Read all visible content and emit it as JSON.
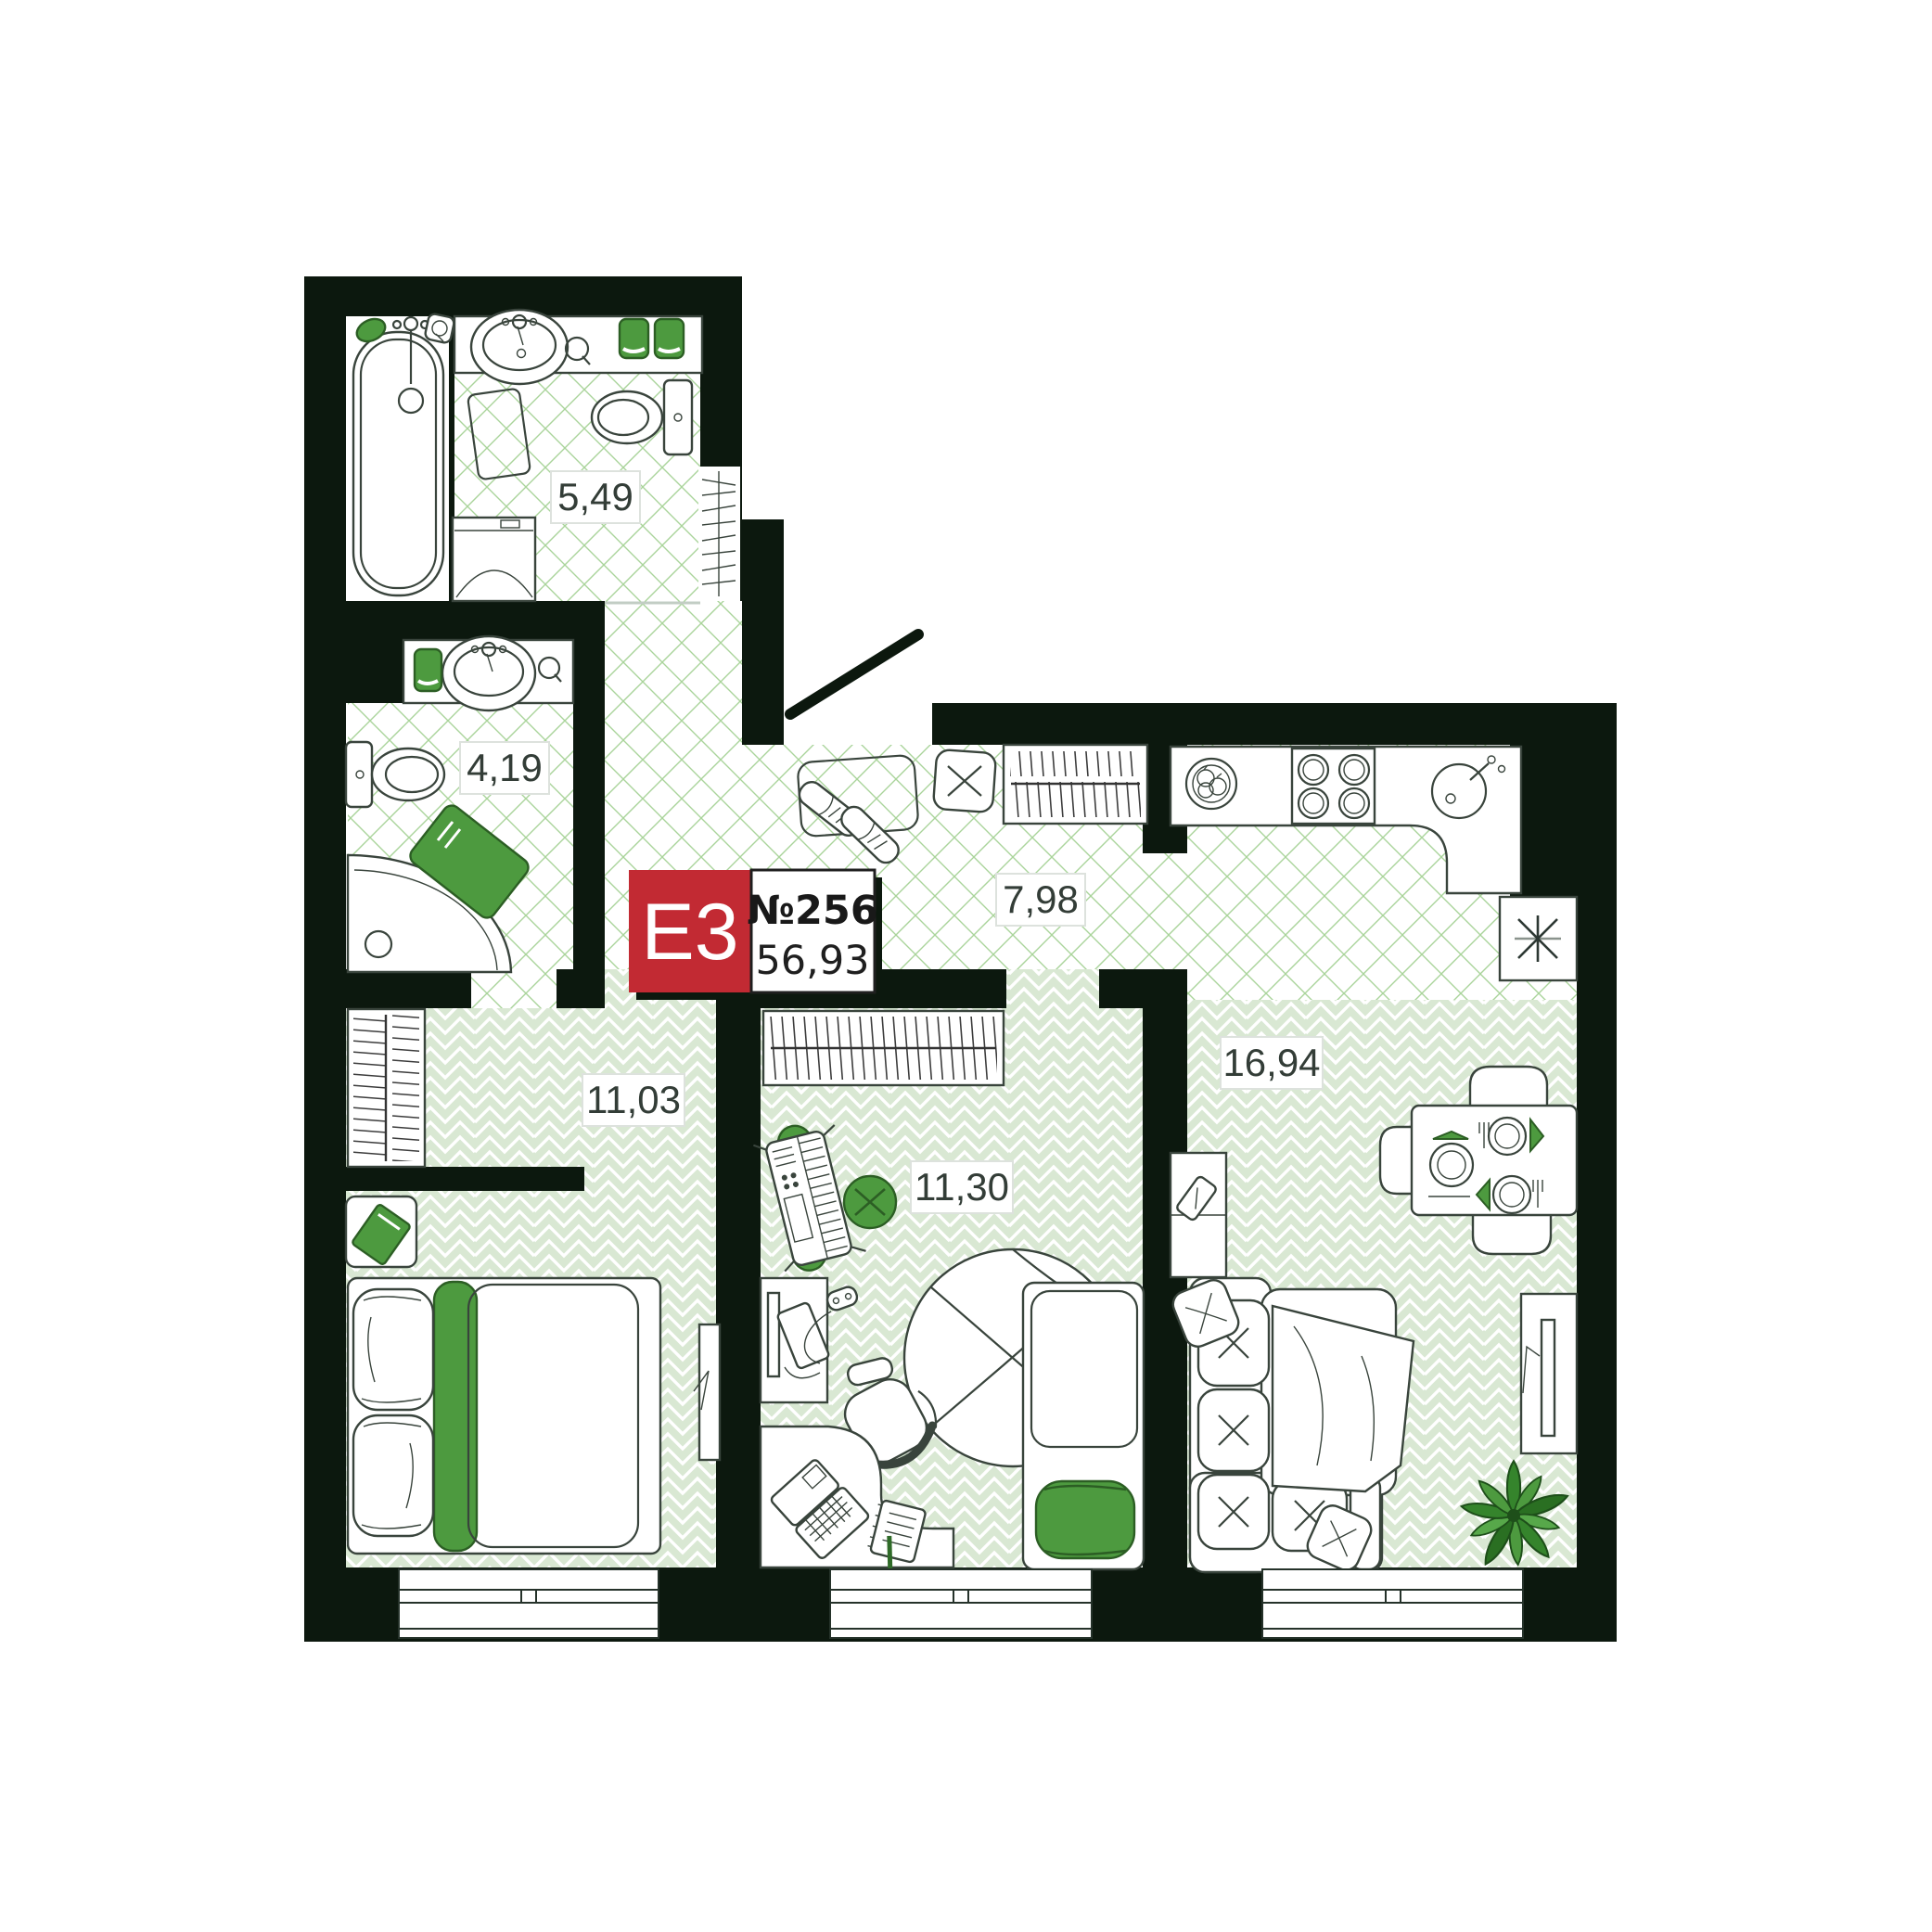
{
  "badge": {
    "type_label": "Е3",
    "number_label": "№256",
    "area_label": "56,93",
    "color": "#c22a33"
  },
  "rooms": {
    "bathroom_main": {
      "area": "5,49"
    },
    "bathroom_guest": {
      "area": "4,19"
    },
    "hallway": {
      "area": "7,98"
    },
    "bedroom": {
      "area": "11,03"
    },
    "kids_room": {
      "area": "11,30"
    },
    "living_kitchen": {
      "area": "16,94"
    }
  },
  "colors": {
    "wall": "#0c180e",
    "accent_green": "#4d9a3f",
    "floor_tint": "#d9e8d3",
    "hatch_green": "#a9d49a",
    "outline": "#39443c",
    "label_text": "#333d37",
    "badge_red": "#c22a33"
  },
  "icons": [
    "bathtub-icon",
    "bath-sink-icon",
    "toilet-icon",
    "washing-machine-icon",
    "towels-icon",
    "soap-icon",
    "shower-corner-icon",
    "bath-mat-icon",
    "valve-icon",
    "radiator-icon",
    "entry-door-icon",
    "shoe-mat-icon",
    "stool-icon",
    "hall-wardrobe-icon",
    "fruit-bowl-icon",
    "stove-icon",
    "kitchen-sink-icon",
    "fridge-icon",
    "dining-table-icon",
    "dining-chair-icon",
    "plate-setting-icon",
    "side-cabinet-icon",
    "sofa-icon",
    "pillow-icon",
    "throw-blanket-icon",
    "tv-icon",
    "plant-icon",
    "window-icon",
    "bedroom-wardrobe-icon",
    "nightstand-icon",
    "book-icon",
    "double-bed-icon",
    "mirror-icon",
    "kids-wardrobe-icon",
    "keyboard-piano-icon",
    "pouf-icon",
    "ball-chair-icon",
    "monitor-desk-icon",
    "game-controller-icon",
    "office-chair-icon",
    "corner-desk-icon",
    "laptop-icon",
    "notebook-icon",
    "kids-bed-icon"
  ]
}
